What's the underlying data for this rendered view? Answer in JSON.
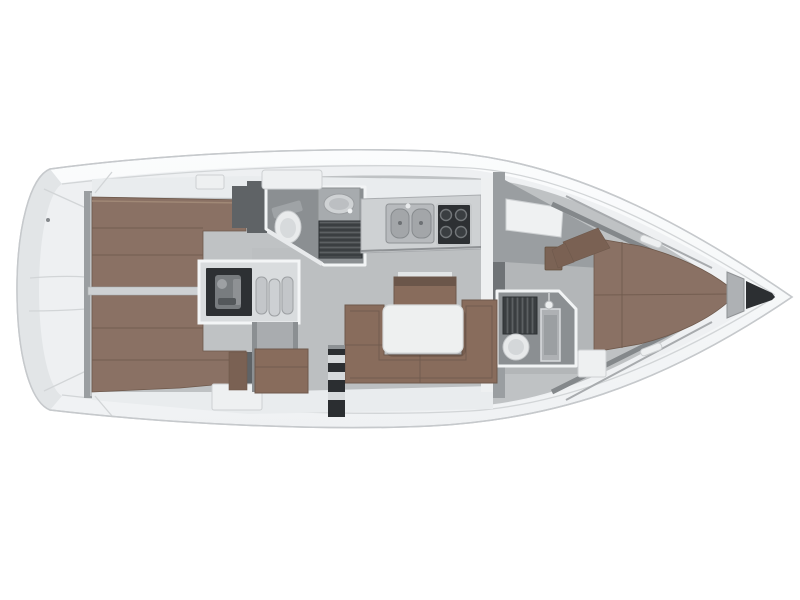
{
  "window": {
    "width": 800,
    "height": 600
  },
  "colors": {
    "background": "#ffffff",
    "hull-outline": "#c6c9cc",
    "deck-light": "#eef0f2",
    "deck-seam": "#d2d5d7",
    "interior-floor": "#bfc2c4",
    "room-floor": "#8b8f92",
    "wall-white": "#f2f4f5",
    "wall-gray": "#9a9ea1",
    "bulkhead-dark": "#5f6366",
    "berth-brown": "#8a7164",
    "berth-brown-dark": "#6e594c",
    "settee-brown": "#886c5c",
    "cushion-dark": "#7a6153",
    "table-white": "#eef0f0",
    "fixture-white": "#e9ebec",
    "appliance-dark": "#2d3033",
    "grate-dark": "#3a3e41",
    "steel-gray": "#aeb1b4",
    "engine-gray": "#787c7f"
  },
  "vessel": {
    "view": "Top-down interior layout rendering of a sailing yacht",
    "orientation": "bow-right",
    "regions": [
      {
        "id": "swim-platform",
        "label": "transom-swim-platform"
      },
      {
        "id": "aft-cabin-port",
        "label": "aft-double-berth-port"
      },
      {
        "id": "aft-cabin-starboard",
        "label": "aft-double-berth-starboard"
      },
      {
        "id": "engine-compartment",
        "label": "engine-under-companionway"
      },
      {
        "id": "companionway-steps",
        "label": "companionway-steps"
      },
      {
        "id": "aft-head",
        "label": "aft-head-toilet-basin-shower"
      },
      {
        "id": "galley",
        "label": "galley-double-sink-stove"
      },
      {
        "id": "salon",
        "label": "salon-u-settee-table"
      },
      {
        "id": "mast-post",
        "label": "mast-post"
      },
      {
        "id": "forward-head",
        "label": "forward-head-toilet-shower"
      },
      {
        "id": "forward-cabin",
        "label": "forward-v-berth"
      },
      {
        "id": "anchor-locker",
        "label": "anchor-locker"
      }
    ]
  }
}
